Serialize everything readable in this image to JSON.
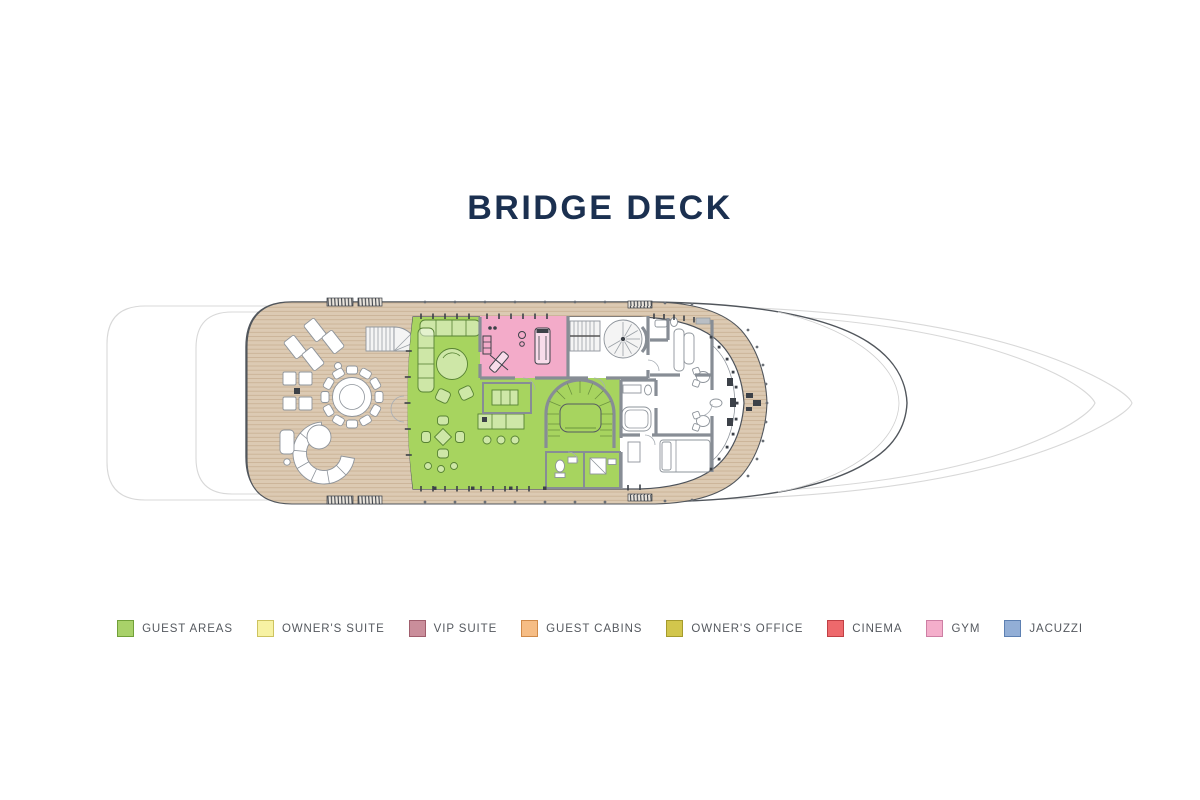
{
  "title": {
    "text": "BRIDGE DECK"
  },
  "legend": [
    {
      "id": "guest-areas",
      "label": "GUEST AREAS",
      "fill": "#a8d169",
      "border": "#71a039"
    },
    {
      "id": "owners-suite",
      "label": "OWNER'S SUITE",
      "fill": "#f7f2a3",
      "border": "#cdc360"
    },
    {
      "id": "vip-suite",
      "label": "VIP SUITE",
      "fill": "#ca8e9b",
      "border": "#a05e6d"
    },
    {
      "id": "guest-cabins",
      "label": "GUEST CABINS",
      "fill": "#f6bd85",
      "border": "#d08a49"
    },
    {
      "id": "owners-office",
      "label": "OWNER'S OFFICE",
      "fill": "#d2c64c",
      "border": "#a59b2d"
    },
    {
      "id": "cinema",
      "label": "CINEMA",
      "fill": "#ee696c",
      "border": "#c04045"
    },
    {
      "id": "gym",
      "label": "GYM",
      "fill": "#f4aecb",
      "border": "#cd7fa4"
    },
    {
      "id": "jacuzzi",
      "label": "JACUZZI",
      "fill": "#92aed6",
      "border": "#5d80b2"
    }
  ],
  "plan": {
    "deck_shown": "Bridge Deck",
    "highlighted_rooms": [
      "guest-areas",
      "gym"
    ],
    "colors": {
      "title": "#1b3050",
      "legend_text": "#55595f",
      "guest_area": "#a7d45f",
      "gym_room": "#f3abc9",
      "deck": "#dccab3",
      "plank": "#c5ac8e",
      "wall": "#878d95",
      "outline": "#51565c",
      "hull_faint": "#d8d8d8",
      "furniture": "#8e949b",
      "guest_stroke": "#578233",
      "dark": "#3c4148"
    }
  }
}
